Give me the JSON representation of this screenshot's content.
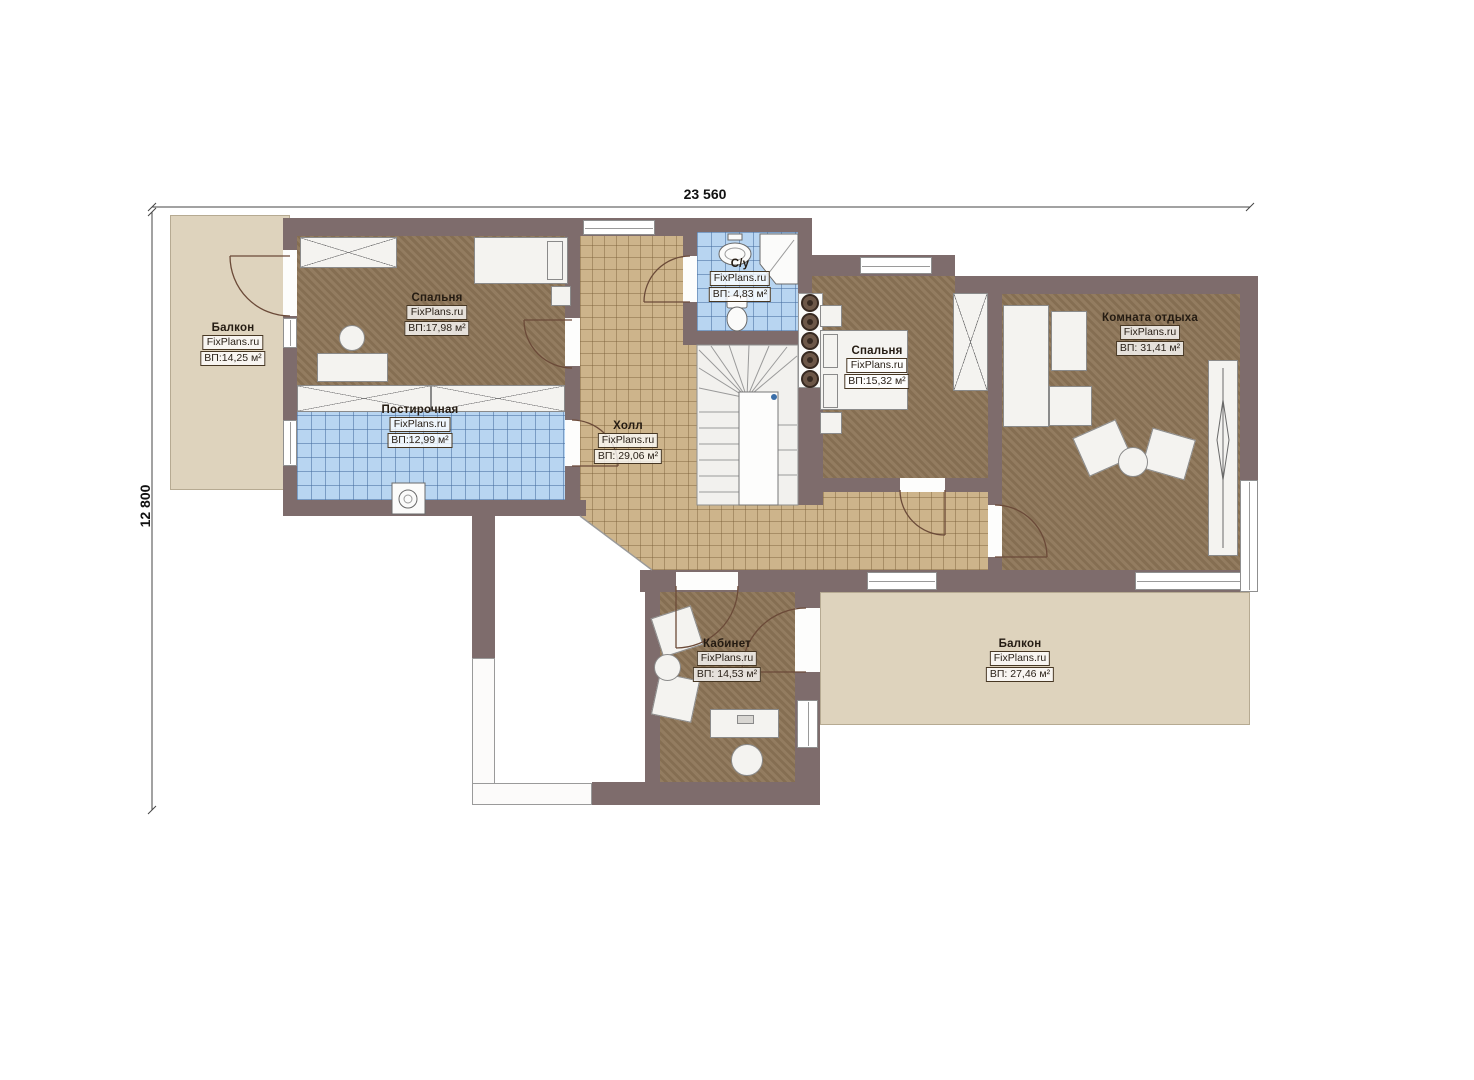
{
  "plan": {
    "watermark": "FixPlans.ru",
    "dimensions": {
      "width": "23 560",
      "height": "12 800"
    },
    "rooms": [
      {
        "id": "balcony-left",
        "name": "Балкон",
        "area": "ВП:14,25 м²"
      },
      {
        "id": "bedroom-1",
        "name": "Спальня",
        "area": "ВП:17,98 м²"
      },
      {
        "id": "laundry",
        "name": "Постирочная",
        "area": "ВП:12,99 м²"
      },
      {
        "id": "hall",
        "name": "Холл",
        "area": "ВП: 29,06 м²"
      },
      {
        "id": "bathroom",
        "name": "С/у",
        "area": "ВП: 4,83 м²"
      },
      {
        "id": "bedroom-2",
        "name": "Спальня",
        "area": "ВП:15,32 м²"
      },
      {
        "id": "lounge",
        "name": "Комната отдыха",
        "area": "ВП: 31,41 м²"
      },
      {
        "id": "office",
        "name": "Кабинет",
        "area": "ВП: 14,53 м²"
      },
      {
        "id": "balcony-bottom",
        "name": "Балкон",
        "area": "ВП: 27,46 м²"
      }
    ],
    "colors": {
      "wall": "#7e6c6c",
      "wood_floor": "#8d7557",
      "tile_floor": "#cdb48b",
      "wet_tile": "#b8d5f1",
      "balcony": "#ded3bd"
    }
  }
}
